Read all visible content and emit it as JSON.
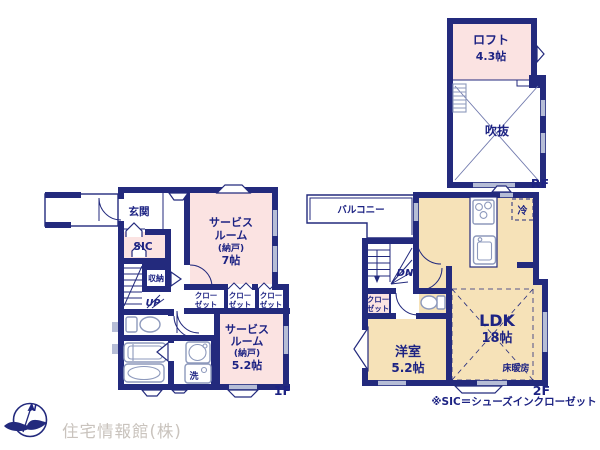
{
  "colors": {
    "wall": "#232a7d",
    "pink": "#fbe3e2",
    "tan": "#f6e2b8",
    "win": "#b6bdd6",
    "fixture": "#8d99bc",
    "ink": "#1d2383",
    "wm": "#c9c3bd",
    "diag": "#7079ad"
  },
  "labels": {
    "rf": {
      "loft_name": "ロフト",
      "loft_size": "4.3帖",
      "void": "吹抜",
      "floor": "RF"
    },
    "f2": {
      "balcony": "バルコニー",
      "fridge": "冷",
      "dn": "DN",
      "closet_l1": "クロー",
      "closet_l2": "ゼット",
      "western_room": "洋室",
      "western_room_size": "5.2帖",
      "ldk": "LDK",
      "ldk_size": "18帖",
      "floor_heating": "床暖房",
      "floor": "2F"
    },
    "f1": {
      "entrance": "玄関",
      "sic": "SIC",
      "storage": "収納",
      "up": "UP",
      "closet_l1": "クロー",
      "closet_l2": "ゼット",
      "service1_l1": "サービス",
      "service1_l2": "ルーム",
      "service1_l3": "(納戸)",
      "service1_l4": "7帖",
      "service2_l1": "サービス",
      "service2_l2": "ルーム",
      "service2_l3": "(納戸)",
      "service2_l4": "5.2帖",
      "laundry": "洗",
      "floor": "1F"
    },
    "note": "※SIC＝シューズインクローゼット",
    "company": "住宅情報館(株)",
    "north": "N"
  }
}
